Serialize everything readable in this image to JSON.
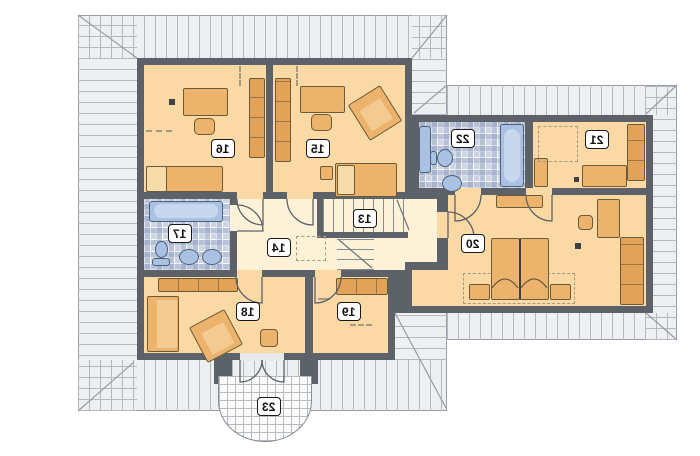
{
  "plan": {
    "kind": "attic-floor-plan",
    "mirrored_labels": true,
    "rooms": [
      {
        "number": "13"
      },
      {
        "number": "14"
      },
      {
        "number": "15"
      },
      {
        "number": "16"
      },
      {
        "number": "17"
      },
      {
        "number": "18"
      },
      {
        "number": "19"
      },
      {
        "number": "20"
      },
      {
        "number": "21"
      },
      {
        "number": "22"
      },
      {
        "number": "23"
      }
    ]
  },
  "colors": {
    "wall": "#5d6269",
    "room_floor": "#fad9a4",
    "hall_floor": "#fdf2d8",
    "roof": "#edeff1",
    "roof_line": "#979da4",
    "tile_floor": "#cdd5e4",
    "fixture_blue": "#a9c2e4",
    "furniture": "#ecb36c",
    "furniture_dark": "#e2a258",
    "balcony": "#fcfcfd"
  }
}
